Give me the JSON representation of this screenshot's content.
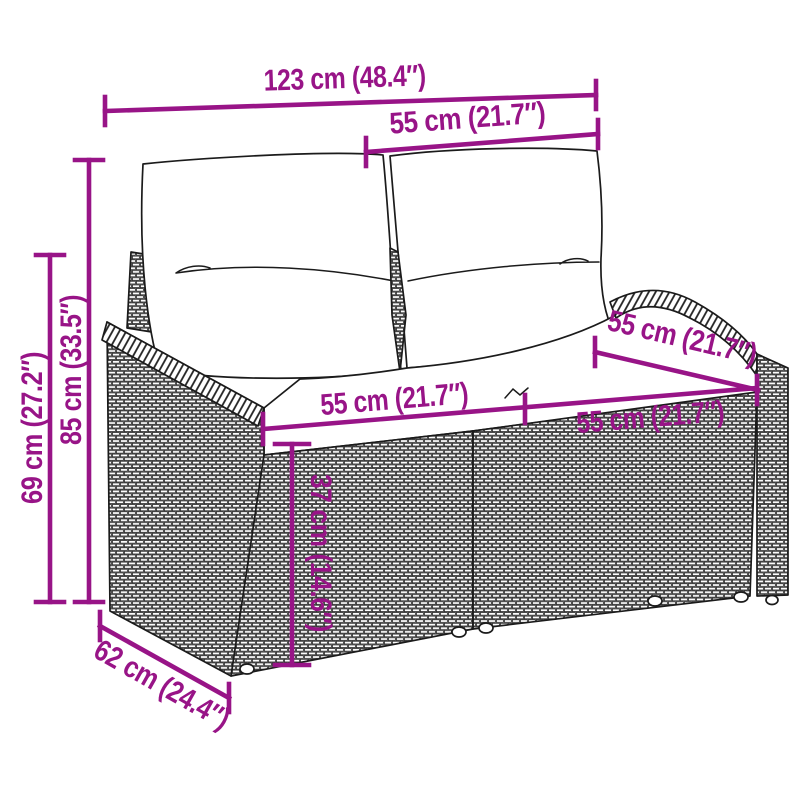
{
  "diagram": {
    "subject": "2-seater rattan garden bench with two back cushions and seat cushion",
    "style": "black line-art product drawing with wicker weave texture",
    "colors": {
      "dimension_accent": "#981487",
      "line_art": "#1b1b1b",
      "background": "#ffffff"
    }
  },
  "dims": {
    "overall_width": "123 cm (48.4″)",
    "backrest_width": "55 cm (21.7″)",
    "overall_height": "85 cm (33.5″)",
    "armrest_height": "69 cm (27.2″)",
    "seat_depth": "55 cm (21.7″)",
    "seat_width_left": "55 cm (21.7″)",
    "seat_width_right": "55 cm (21.7″)",
    "seat_height": "37 cm (14.6″)",
    "overall_depth": "62 cm (24.4″)"
  }
}
